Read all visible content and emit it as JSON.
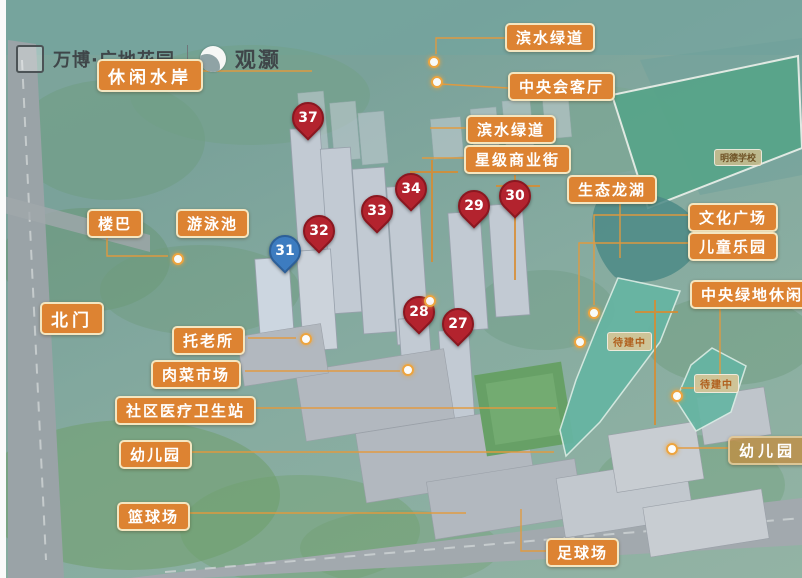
{
  "brand": {
    "name": "万博·广地花园",
    "separator": "丨",
    "logo_text": "观灏"
  },
  "labels": {
    "xiuxian": "休闲水岸",
    "binshui1": "滨水绿道",
    "huiketing": "中央会客厅",
    "binshui2": "滨水绿道",
    "shangyejie": "星级商业街",
    "longhu": "生态龙湖",
    "wenhua": "文化广场",
    "ertong": "儿童乐园",
    "lvdi": "中央绿地休闲区",
    "louba": "楼巴",
    "youyongchi": "游泳池",
    "beimen": "北门",
    "tuolaosuo": "托老所",
    "roucai": "肉菜市场",
    "yiliao": "社区医疗卫生站",
    "youeryuan_left": "幼儿园",
    "lanqiu": "篮球场",
    "zuqiu": "足球场",
    "youeryuan_right": "幼儿园",
    "school": "明德学校",
    "under_construction_1": "待建中",
    "under_construction_2": "待建中"
  },
  "pins": [
    {
      "number": "37",
      "color": "red"
    },
    {
      "number": "34",
      "color": "red"
    },
    {
      "number": "33",
      "color": "red"
    },
    {
      "number": "32",
      "color": "red"
    },
    {
      "number": "31",
      "color": "blue"
    },
    {
      "number": "30",
      "color": "red"
    },
    {
      "number": "29",
      "color": "red"
    },
    {
      "number": "28",
      "color": "red"
    },
    {
      "number": "27",
      "color": "red"
    }
  ],
  "colors": {
    "label_bg": "#DD8332",
    "pin_red": "#B3232E",
    "pin_blue": "#3D7CC0",
    "construction_fill": "#66B5A3",
    "school_field": "#57A489"
  }
}
